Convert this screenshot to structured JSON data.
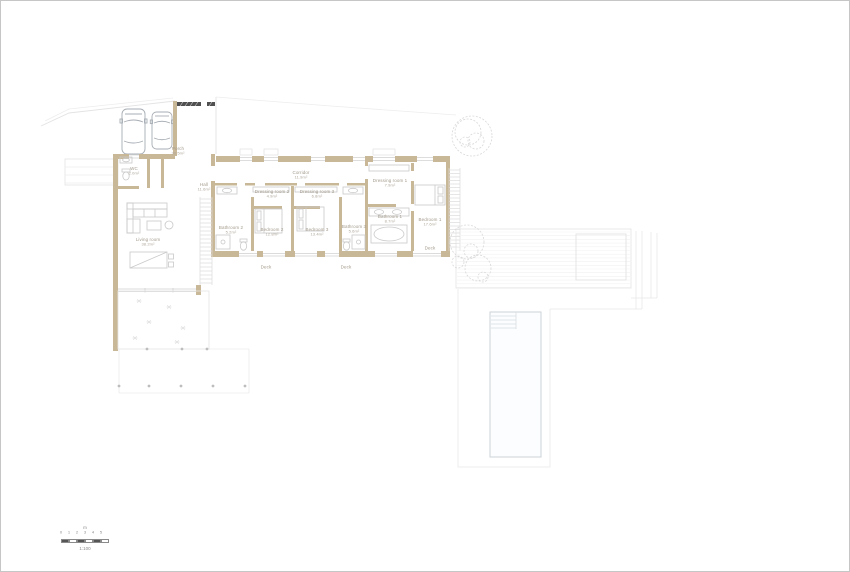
{
  "rooms": [
    {
      "id": "porch",
      "label": "Porch",
      "area": "30.5m²"
    },
    {
      "id": "wc",
      "label": "WC",
      "area": "2.0m²"
    },
    {
      "id": "hall",
      "label": "Hall",
      "area": "11.6m²"
    },
    {
      "id": "corridor",
      "label": "Corridor",
      "area": "11.9m²"
    },
    {
      "id": "dressing2",
      "label": "Dressing room 2",
      "area": "4.9m²"
    },
    {
      "id": "dressing3",
      "label": "Dressing room 3",
      "area": "6.8m²"
    },
    {
      "id": "dressing1",
      "label": "Dressing room 1",
      "area": "7.9m²"
    },
    {
      "id": "bathroom2",
      "label": "Bathroom 2",
      "area": "5.2m²"
    },
    {
      "id": "bedroom2",
      "label": "Bedroom 2",
      "area": "12.8m²"
    },
    {
      "id": "bedroom3",
      "label": "Bedroom 3",
      "area": "13.4m²"
    },
    {
      "id": "bathroom3",
      "label": "Bathroom 3",
      "area": "5.6m²"
    },
    {
      "id": "bathroom1",
      "label": "Bathroom 1",
      "area": "8.7m²"
    },
    {
      "id": "bedroom1",
      "label": "Bedroom 1",
      "area": "17.6m²"
    },
    {
      "id": "living",
      "label": "Living room",
      "area": "38.2m²"
    },
    {
      "id": "deck_b2",
      "label": "Deck",
      "area": ""
    },
    {
      "id": "deck_b3",
      "label": "Deck",
      "area": ""
    },
    {
      "id": "deck_b1",
      "label": "Deck",
      "area": ""
    }
  ],
  "scalebar": {
    "ticks": [
      "0",
      "1",
      "2",
      "3",
      "4",
      "5"
    ],
    "unit_label": "m",
    "scale_label": "1:100"
  },
  "colors": {
    "wall": "#c9b897",
    "hatch": "#4f4f4f",
    "line_light": "#e6e6e6",
    "line_board": "#f1f1f1",
    "furniture": "#c9c9c9",
    "car": "#a7adb4",
    "pool": "#ccd3d7",
    "text": "#a39a8b"
  }
}
